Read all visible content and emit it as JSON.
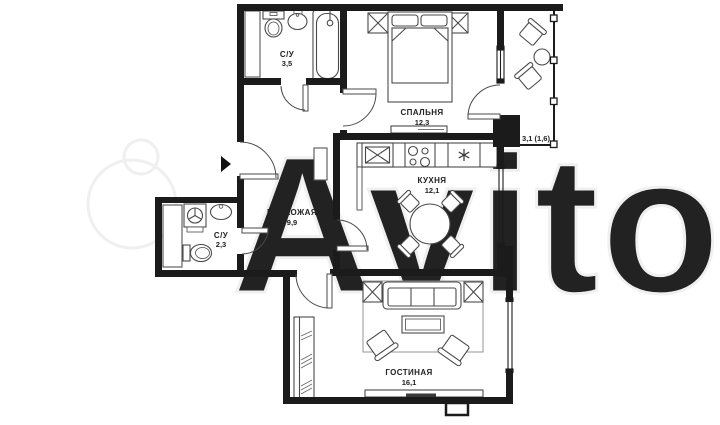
{
  "floor_plan": {
    "watermark": "Avito",
    "rooms": {
      "bathroom_top": {
        "name": "С/У",
        "area": "3,5"
      },
      "bedroom": {
        "name": "СПАЛЬНЯ",
        "area": "12,3"
      },
      "balcony": {
        "area_label": "3,1 (1,6)"
      },
      "kitchen": {
        "name": "КУХНЯ",
        "area": "12,1"
      },
      "hallway": {
        "name": "ПРИХОЖАЯ",
        "area": "9,9"
      },
      "bathroom_small": {
        "name": "С/У",
        "area": "2,3"
      },
      "living_room": {
        "name": "ГОСТИНАЯ",
        "area": "16,1"
      }
    },
    "icons": [
      "entrance-arrow-icon",
      "toilet-icon",
      "sink-icon",
      "bathtub-icon",
      "duct-icon",
      "washing-machine-icon",
      "bed-icon",
      "nightstand-icon",
      "dresser-icon",
      "kitchen-sink-icon",
      "stove-icon",
      "fridge-asterisk-icon",
      "dining-table-icon",
      "chair-icon",
      "sofa-icon",
      "side-table-icon",
      "coffee-table-icon",
      "armchair-icon",
      "rug-icon",
      "wardrobe-icon",
      "closet-icon",
      "balcony-chair-icon",
      "balcony-table-icon",
      "window-icon",
      "door-arc-icon"
    ],
    "colors": {
      "background": "#ffffff",
      "walls": "#1b1b1b",
      "furniture": "#4a4a4a",
      "text": "#222222",
      "watermark": "#efefef"
    }
  }
}
